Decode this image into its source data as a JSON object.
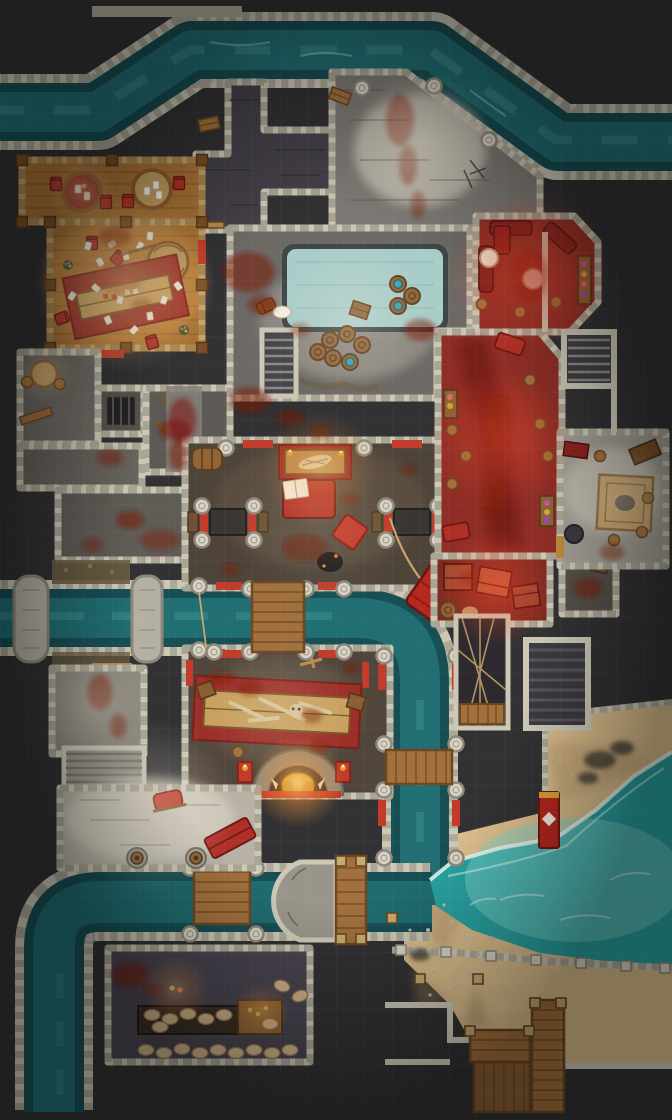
{
  "meta": {
    "kind": "top-down fantasy battle map",
    "grid_px": 28,
    "width_px": 672,
    "height_px": 1120,
    "visible_text": "none"
  },
  "palette": {
    "bg": "#323234",
    "gridline": "#ffffff",
    "wall": "#cdc8b6",
    "mortar": "#8d887a",
    "floorDark": "#454049",
    "floorGray": "#6d6965",
    "floorMid": "#7d7974",
    "floorBright": "#c2bdb0",
    "floorPlaza": "#b7b2a5",
    "hallFloor": "#4e443a",
    "feastFloor": "#51463b",
    "storageFloor": "#49444f",
    "woodFloor": "#a87134",
    "woodFloorLight": "#c19254",
    "timber": "#c7a368",
    "timberDark": "#8a6a3a",
    "wood": "#a1703c",
    "woodDark": "#6b4722",
    "water": "#24767a",
    "waterDeep": "#174f55",
    "waterLight": "#5fb3a8",
    "sea": "#2aa0a0",
    "seaLight": "#7fd4cb",
    "foam": "#e8f8f2",
    "pool": "#a9cdc9",
    "poolEdge": "#3f4648",
    "sand": "#d9bc8b",
    "sandShade": "#a98a62",
    "pebble": "#b9b9b2",
    "redFloor": "#8e2e26",
    "carpet": "#9c2f28",
    "red": "#b5281e",
    "redBright": "#c23b2b",
    "redDark": "#701812",
    "blood": "#7c120c",
    "gold": "#d9a437",
    "flame": "#ffc36b",
    "barrel": "#916335",
    "barrelBand": "#5e3f20",
    "grate": "#232327",
    "stairDark": "#3a3a40",
    "stairTread": "#8d897f",
    "rope": "#c8a66a",
    "white": "#f2ede2",
    "sack": "#cbb089",
    "moss": "#6b5d42"
  },
  "regions": [
    {
      "id": "north-canal",
      "label": "stone-walled canal across the top"
    },
    {
      "id": "stone-quay",
      "label": "bright bloodstained quay"
    },
    {
      "id": "north-corridors",
      "label": "dark stone corridors with benches"
    },
    {
      "id": "tavern",
      "label": "wooden tavern with card tables and scattered cards"
    },
    {
      "id": "pool-room",
      "label": "bath room with rectangular pool and barrels"
    },
    {
      "id": "red-lounge",
      "label": "red-lit lounge with sofas and flower planters"
    },
    {
      "id": "red-corridor",
      "label": "red-lit corridor with stools and beds"
    },
    {
      "id": "red-storeroom",
      "label": "red-lit crate store"
    },
    {
      "id": "east-side-room",
      "label": "side room with square rug"
    },
    {
      "id": "west-warren",
      "label": "small bloodied service rooms"
    },
    {
      "id": "great-hall",
      "label": "pillared hall with altar, bed and shrines"
    },
    {
      "id": "feast-hall",
      "label": "feast hall with bone-strewn table and boar fireplace"
    },
    {
      "id": "middle-canal",
      "label": "canal with aqueduct piers and plank bridge"
    },
    {
      "id": "south-basin",
      "label": "dock basin with pier and plank dock"
    },
    {
      "id": "plaza",
      "label": "bright southwest plaza"
    },
    {
      "id": "storage-room",
      "label": "storeroom with sack shelves"
    },
    {
      "id": "beach",
      "label": "pebbled sand beach"
    },
    {
      "id": "sea",
      "label": "bright teal sea"
    },
    {
      "id": "beach-stairs",
      "label": "wide dark stairs to the beach"
    },
    {
      "id": "rope-lift",
      "label": "rope lift shaft with platform"
    },
    {
      "id": "beach-deck",
      "label": "wooden deck and steps on the beach"
    }
  ],
  "objects": [
    "round card tables",
    "overturned round table",
    "long tavern table on red rug",
    "red chairs",
    "playing cards",
    "blood stains",
    "flower pots",
    "rectangular pool",
    "barrels",
    "water barrels",
    "crates",
    "stone pillars",
    "red door mats",
    "red wall banners",
    "altar with carcass and candles",
    "red bed with open book",
    "red cushion",
    "shrine tables",
    "tipped red dumpster",
    "rope",
    "feast table with bones",
    "golden boar fireplace statue",
    "candle pedestals",
    "plank bridges",
    "aqueduct piers",
    "stairs",
    "rope lift platform",
    "buckets on stone pads",
    "red cap",
    "red bench",
    "sack shelves",
    "grain sacks",
    "stone pier",
    "wooden dock",
    "rope fence posts",
    "red standing banner",
    "floor grate",
    "benches",
    "square rug",
    "seaweed clumps",
    "pebbles"
  ]
}
